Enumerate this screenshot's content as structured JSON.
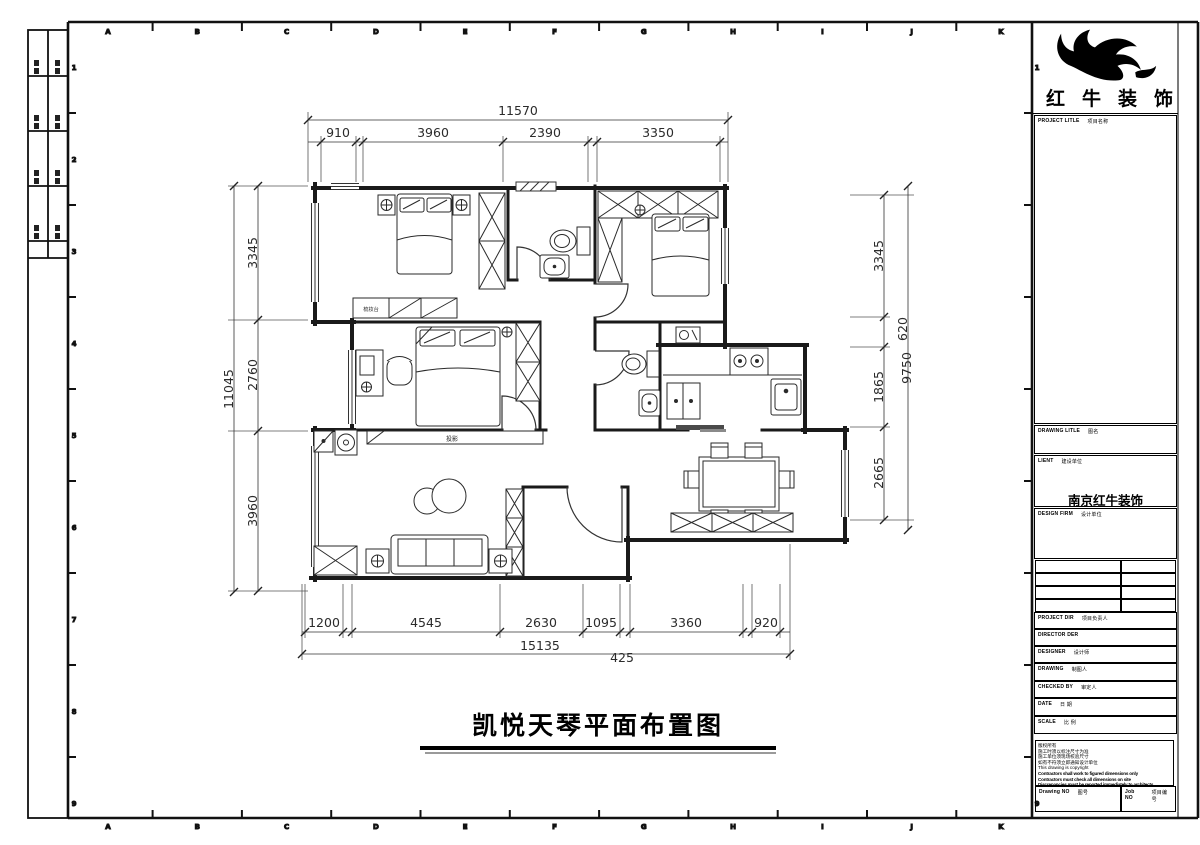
{
  "frame": {
    "grid_letters": [
      "A",
      "B",
      "C",
      "D",
      "E",
      "F",
      "G",
      "H",
      "I",
      "J",
      "K"
    ],
    "grid_numbers": [
      "1",
      "2",
      "3",
      "4",
      "5",
      "6",
      "7",
      "8",
      "9"
    ]
  },
  "title_block": {
    "brand": "红牛装饰",
    "project_title": {
      "en": "PROJECT LITLE",
      "cn": "项目名称"
    },
    "drawing_title": {
      "en": "DRAWING LITLE",
      "cn": "图名"
    },
    "client": {
      "en": "LIENT",
      "cn": "建设单位"
    },
    "client_name": "南京红牛装饰",
    "design_firm": {
      "en": "DESIGN FIRM",
      "cn": "设计单位"
    },
    "rows": [
      {
        "en": "PROJECT DIR",
        "cn": "项目负责人"
      },
      {
        "en": "DIRECTOR DER",
        "cn": ""
      },
      {
        "en": "DESIGNER",
        "cn": "设计师"
      },
      {
        "en": "DRAWING",
        "cn": "制图人"
      },
      {
        "en": "CHECKED BY",
        "cn": "审定人"
      },
      {
        "en": "DATE",
        "cn": "日 期"
      },
      {
        "en": "SCALE",
        "cn": "比 例"
      }
    ],
    "nos": {
      "drawing_no": {
        "en": "Drawing NO",
        "cn": "图号"
      },
      "job_no": {
        "en": "Job NO",
        "cn": "项目编号"
      }
    },
    "copyright": {
      "lines": [
        "版权所有",
        "施工时须以标注尺寸为准",
        "施工单位须现场校验尺寸",
        "如有不符须立即通知设计单位",
        "This drawing is copyright",
        "Contractors shall work to figured dimensions only",
        "Contractors must check all dimensions on site",
        "Discrepancies must be reported immediately to architects"
      ]
    }
  },
  "drawing": {
    "title": "凯悦天琴平面布置图",
    "labels": {
      "projection": "投影",
      "dresser": "梳妆台"
    }
  },
  "dimensions": {
    "top": {
      "total": "11570",
      "segments": [
        "910",
        "3960",
        "2390",
        "3350"
      ]
    },
    "bottom": {
      "total": "15135",
      "extra": "425",
      "segments": [
        "1200",
        "4545",
        "2630",
        "1095",
        "3360",
        "920"
      ]
    },
    "left": {
      "total": "11045",
      "segments": [
        "3345",
        "2760",
        "3960"
      ]
    },
    "right": {
      "totals": [
        "620",
        "9750"
      ],
      "segments": [
        "3345",
        "1865",
        "2665"
      ]
    }
  }
}
